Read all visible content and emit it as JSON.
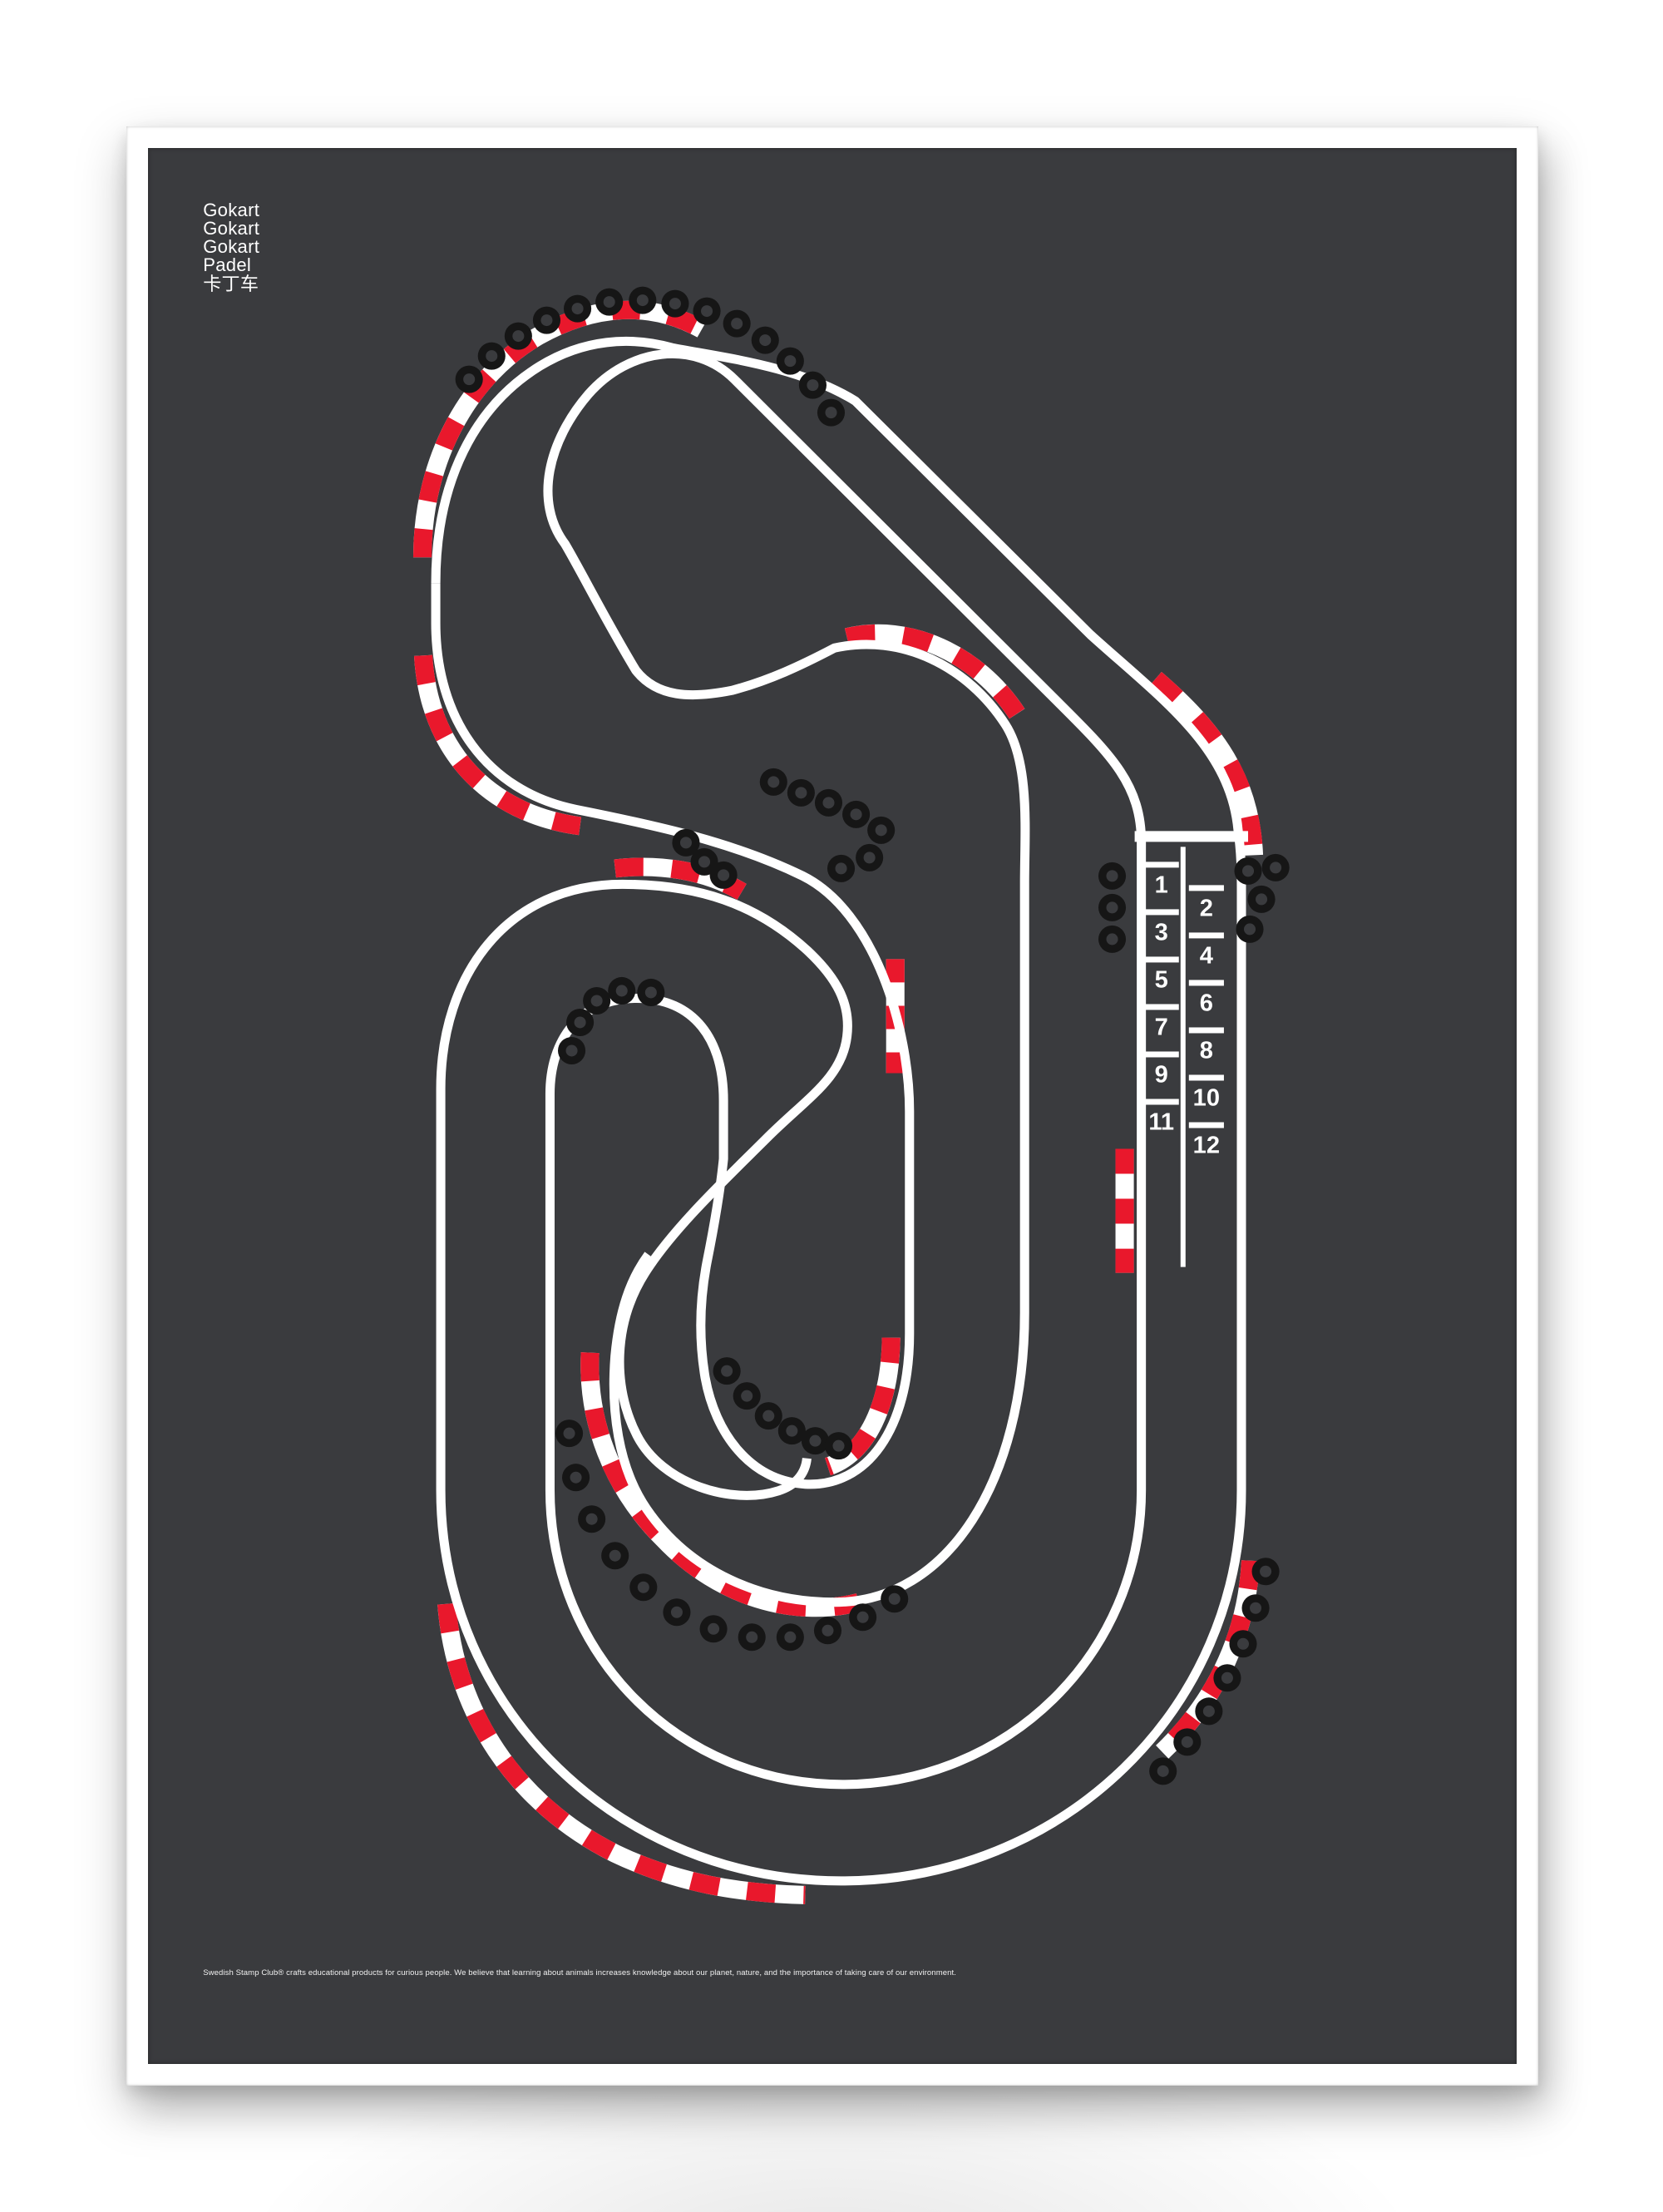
{
  "poster": {
    "title_lines": [
      "Gokart",
      "Gokart",
      "Gokart",
      "Padel",
      "卡丁车"
    ],
    "footer_text": "Swedish Stamp Club® crafts educational products for curious people. We believe that learning about animals increases knowledge about our planet, nature, and the importance of taking care of our environment."
  },
  "grid": {
    "left_column": [
      "1",
      "3",
      "5",
      "7",
      "9",
      "11"
    ],
    "right_column": [
      "2",
      "4",
      "6",
      "8",
      "10",
      "12"
    ]
  },
  "colors": {
    "page_background": "#ffffff",
    "frame_white": "#ffffff",
    "poster_background": "#3a3b3e",
    "track_line": "#ffffff",
    "kerb_red": "#e9182c",
    "tire_black": "#161616"
  }
}
